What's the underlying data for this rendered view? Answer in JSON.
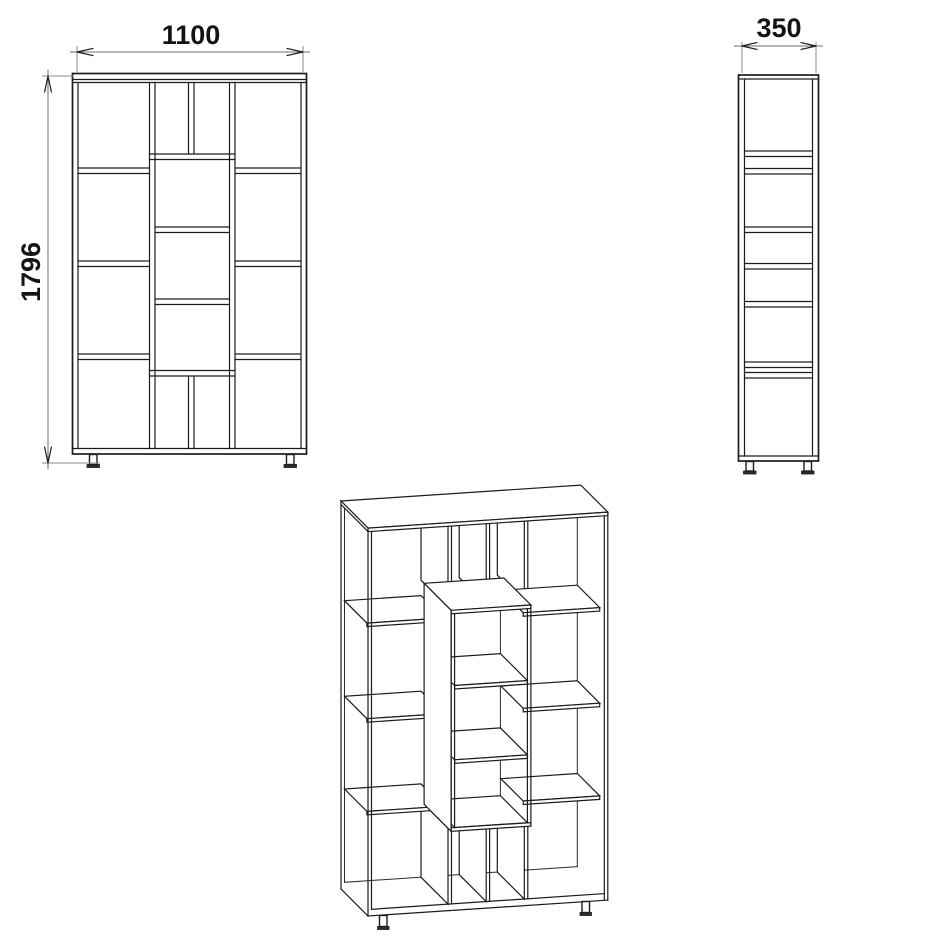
{
  "drawing": {
    "subject": "bookcase shelving unit technical drawing",
    "views_shown": 3
  },
  "dimensions": {
    "width": "1100",
    "height": "1796",
    "depth": "350"
  },
  "colors": {
    "line": "#1c1c1c",
    "dimension_line": "#6e6e6e",
    "background": "#ffffff"
  }
}
